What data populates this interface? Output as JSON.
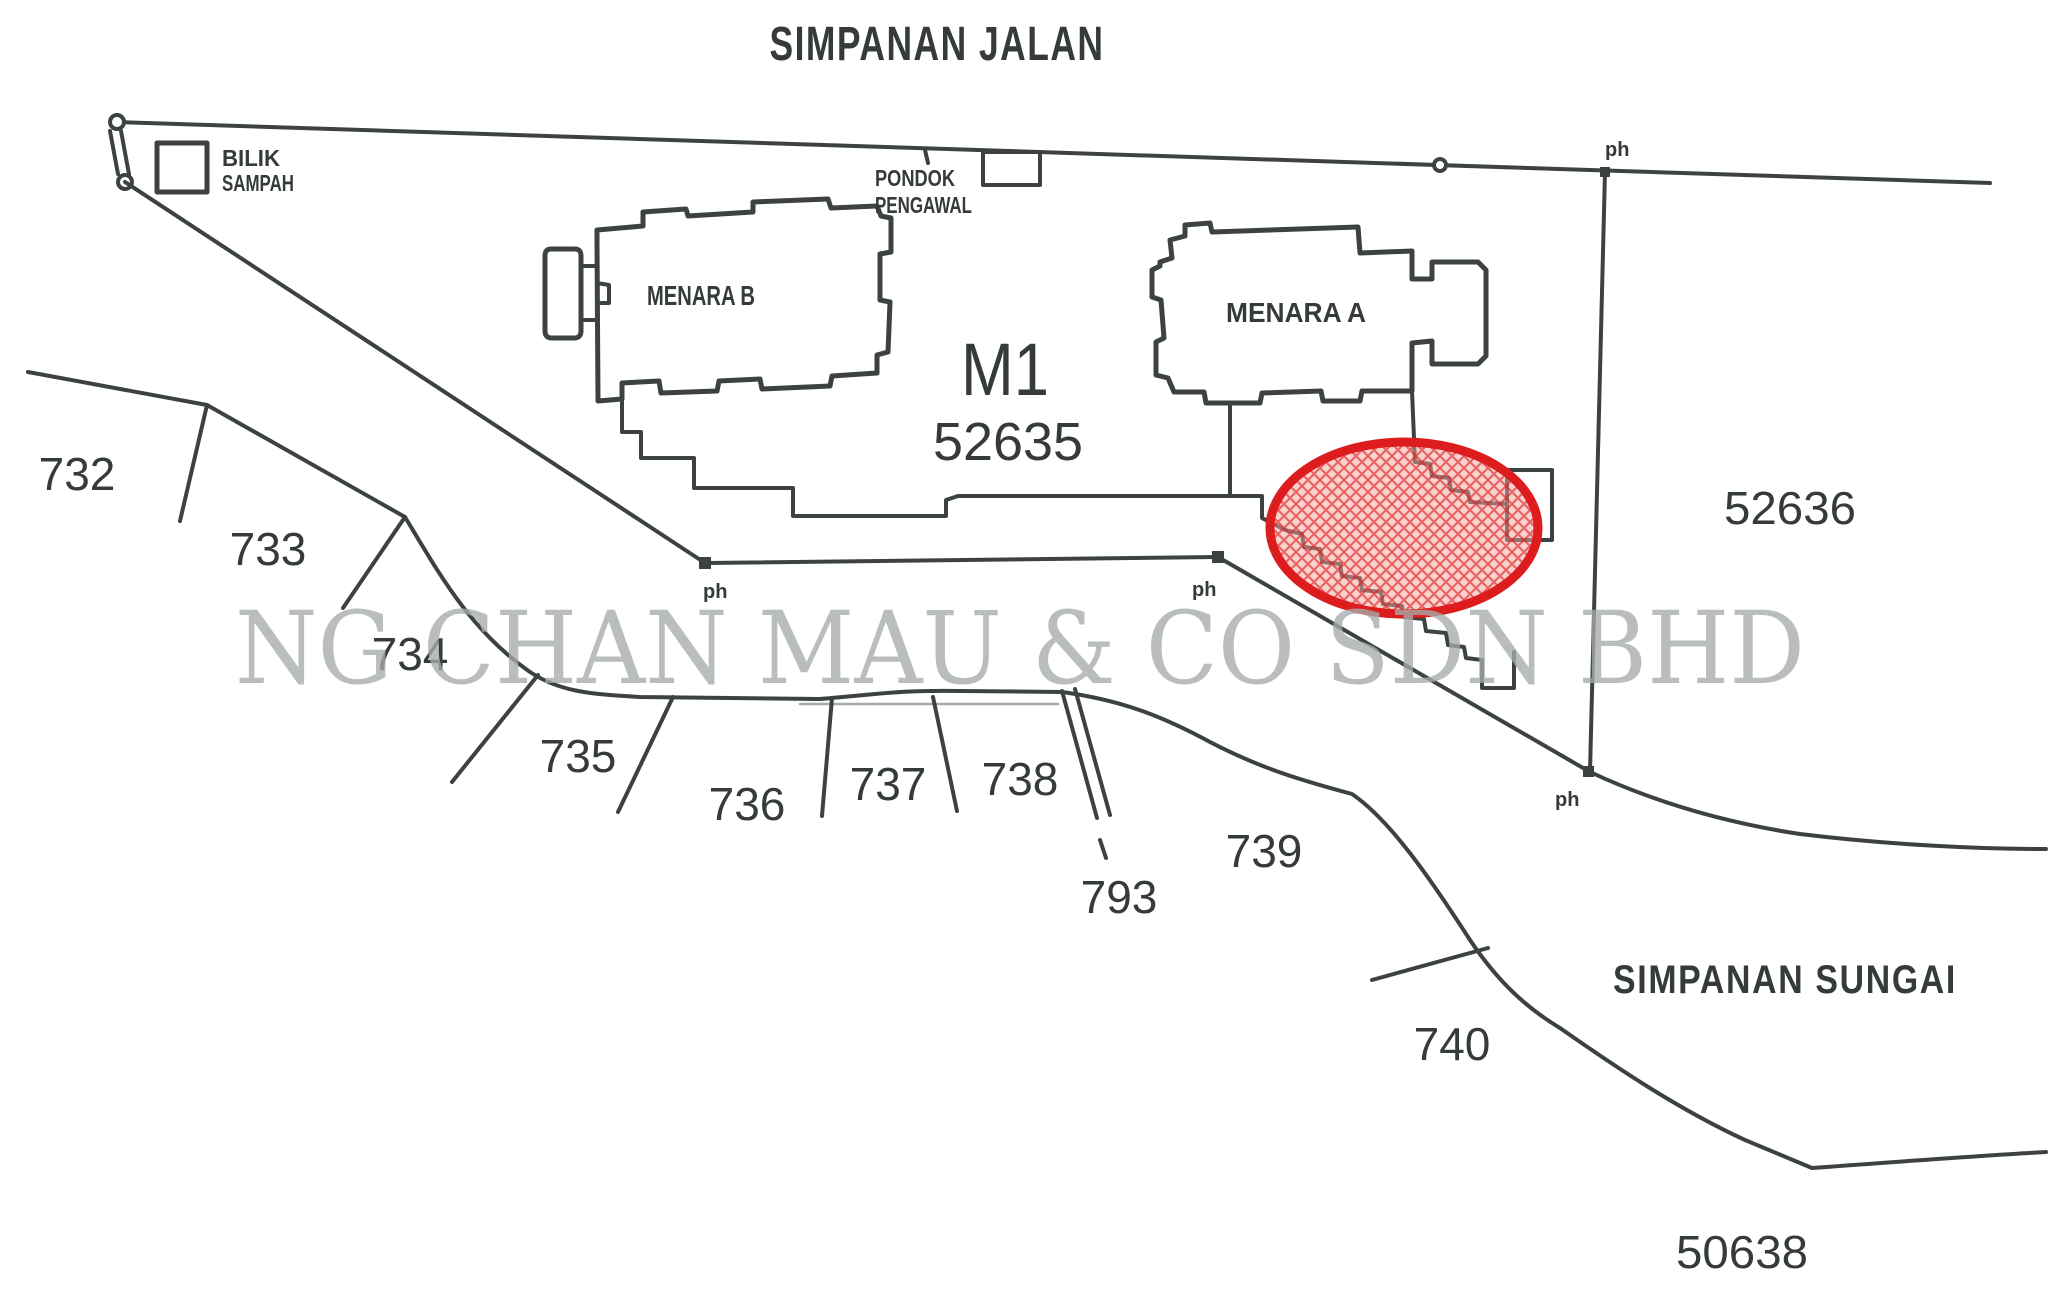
{
  "plan": {
    "road_reserve_label": "SIMPANAN JALAN",
    "river_reserve_label": "SIMPANAN SUNGAI",
    "watermark_text": "NG CHAN MAU & CO SDN BHD",
    "building_block_label": "M1",
    "main_lot_number": "52635",
    "tower_a_label": "MENARA A",
    "tower_b_label": "MENARA B",
    "bin_room_label_line1": "BILIK",
    "bin_room_label_line2": "SAMPAH",
    "guard_house_label_line1": "PONDOK",
    "guard_house_label_line2": "PENGAWAL",
    "east_lot_number": "52636",
    "south_lot_number": "50638",
    "lot_numbers": [
      "732",
      "733",
      "734",
      "735",
      "736",
      "737",
      "738",
      "739",
      "740",
      "793"
    ],
    "survey_mark_label": "ph"
  },
  "colors": {
    "ink": "#3c4242",
    "highlight_red": "#dd1d1d",
    "highlight_fill_pink": "#f2a6a0",
    "watermark_gray": "#a6abab",
    "paper_white": "#ffffff"
  }
}
